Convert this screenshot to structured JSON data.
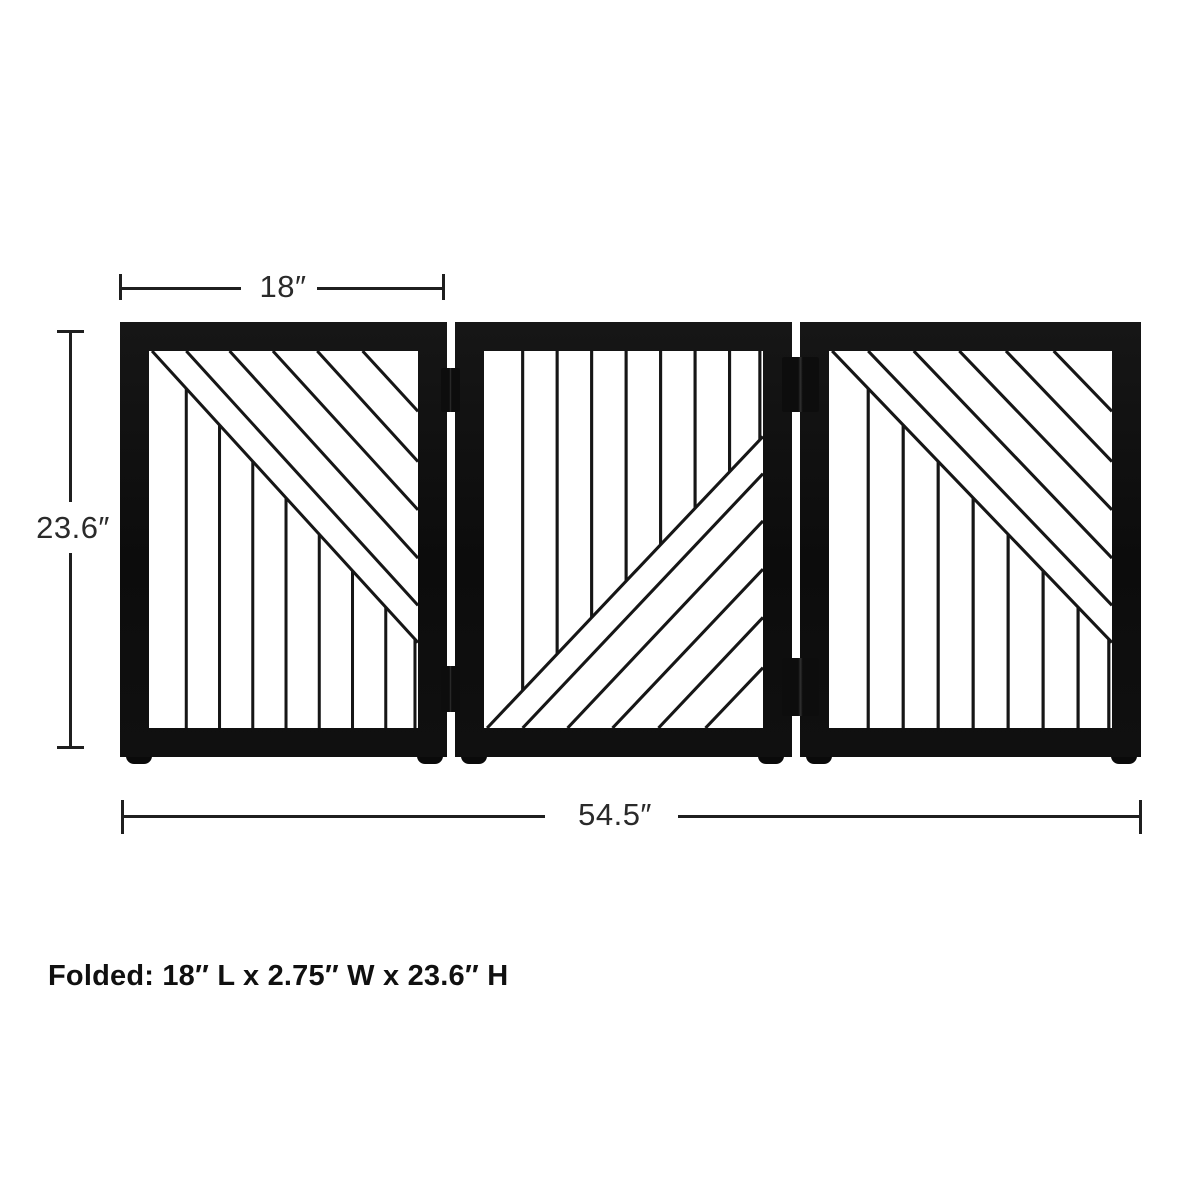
{
  "page": {
    "background_color": "#ffffff",
    "description": "Product dimension diagram of a three-panel freestanding folding pet gate"
  },
  "annotations": {
    "panel_width_label": "18″",
    "height_label": "23.6″",
    "total_width_label": "54.5″",
    "folded_note": "Folded: 18″ L x 2.75″ W x 23.6″ H"
  },
  "gate": {
    "panel_count": 3,
    "panels": [
      {
        "position": "left",
        "pattern": "diagonal-slats-upper-right-vertical-slats-lower-left"
      },
      {
        "position": "middle",
        "pattern": "vertical-slats-upper-left-diagonal-slats-lower-right"
      },
      {
        "position": "right",
        "pattern": "diagonal-slats-upper-right-vertical-slats-lower-left"
      }
    ],
    "diagonal_slats_per_panel": 6,
    "vertical_slats_per_panel": 8,
    "hinge_pairs": 2,
    "feet_count": 6
  },
  "colors": {
    "frame": "#101010",
    "slat": "#161616",
    "dimension_line": "#1f1f1f",
    "dimension_text": "#2a2a2a",
    "folded_text": "#101010",
    "background": "#ffffff"
  }
}
